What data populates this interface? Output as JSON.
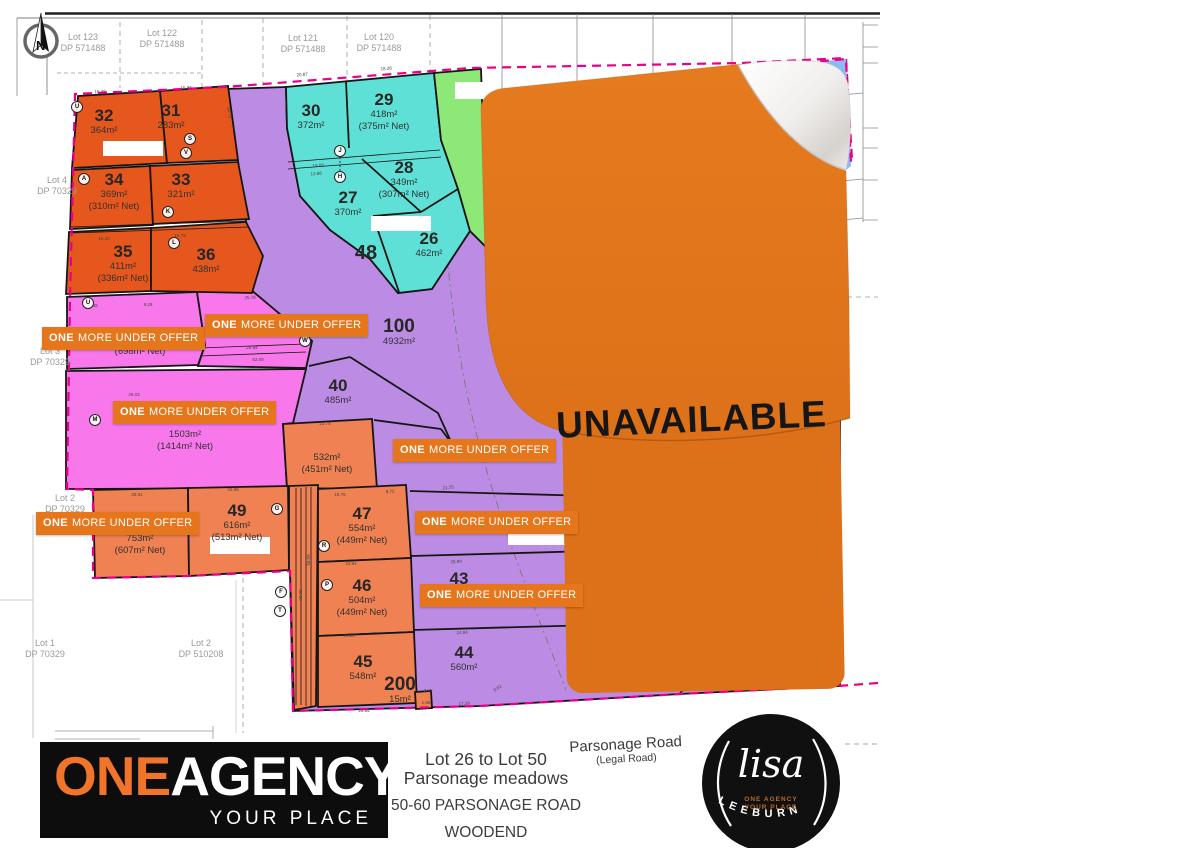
{
  "meta": {
    "unavailable": "UNAVAILABLE"
  },
  "compass": {
    "letter": "N"
  },
  "colors": {
    "lot_orange": "#E6571D",
    "lot_salmon": "#EF8152",
    "lot_teal": "#5FE0D6",
    "lot_green": "#8DE878",
    "lot_purple": "#BC8CE4",
    "lot_pink": "#F878EC",
    "banner_orange": "#E5761C",
    "sticker_orange": "#E1771E",
    "boundary_magenta": "#E8008C",
    "logo_orange": "#F0742A",
    "curl_blue": "#8ABCF2"
  },
  "neighbors": [
    {
      "l1": "Lot 123",
      "l2": "DP 571488",
      "x": 83,
      "y": 32
    },
    {
      "l1": "Lot 122",
      "l2": "DP 571488",
      "x": 162,
      "y": 28
    },
    {
      "l1": "Lot 121",
      "l2": "DP 571488",
      "x": 303,
      "y": 33
    },
    {
      "l1": "Lot 120",
      "l2": "DP 571488",
      "x": 379,
      "y": 32
    },
    {
      "l1": "Lot 4",
      "l2": "DP 70329",
      "x": 57,
      "y": 175
    },
    {
      "l1": "Lot 3",
      "l2": "DP 70329",
      "x": 50,
      "y": 346
    },
    {
      "l1": "Lot 2",
      "l2": "DP 70329",
      "x": 65,
      "y": 493
    },
    {
      "l1": "Lot 1",
      "l2": "DP 70329",
      "x": 45,
      "y": 638
    },
    {
      "l1": "Lot 2",
      "l2": "DP 510208",
      "x": 201,
      "y": 638
    }
  ],
  "lots": [
    {
      "n": "32",
      "a": "364m²",
      "x": 104,
      "y": 107
    },
    {
      "n": "31",
      "a": "283m²",
      "x": 171,
      "y": 102
    },
    {
      "n": "34",
      "a": "369m²",
      "net": "(310m² Net)",
      "x": 114,
      "y": 171
    },
    {
      "n": "33",
      "a": "321m²",
      "x": 181,
      "y": 171
    },
    {
      "n": "35",
      "a": "411m²",
      "net": "(336m² Net)",
      "x": 123,
      "y": 243
    },
    {
      "n": "36",
      "a": "438m²",
      "x": 206,
      "y": 246
    },
    {
      "n": "30",
      "a": "372m²",
      "x": 311,
      "y": 102
    },
    {
      "n": "29",
      "a": "418m²",
      "net": "(375m² Net)",
      "x": 384,
      "y": 91
    },
    {
      "n": "28",
      "a": "349m²",
      "net": "(307m² Net)",
      "x": 404,
      "y": 159
    },
    {
      "n": "27",
      "a": "370m²",
      "x": 348,
      "y": 189
    },
    {
      "n": "26",
      "a": "462m²",
      "x": 429,
      "y": 230
    },
    {
      "n": "48",
      "ns": 20,
      "x": 366,
      "y": 244
    },
    {
      "n": "100",
      "a": "4932m²",
      "ns": 19,
      "x": 399,
      "y": 318
    },
    {
      "n": "40",
      "a": "485m²",
      "x": 338,
      "y": 377
    },
    {
      "a": "532m²",
      "net": "(451m² Net)",
      "x": 327,
      "y": 452
    },
    {
      "net": "(698m² Net)",
      "x": 140,
      "y": 346
    },
    {
      "a": "1503m²",
      "net": "(1414m² Net)",
      "x": 185,
      "y": 429
    },
    {
      "a": "753m²",
      "net": "(607m² Net)",
      "x": 140,
      "y": 533
    },
    {
      "n": "49",
      "a": "616m²",
      "net": "(513m² Net)",
      "x": 237,
      "y": 502
    },
    {
      "n": "47",
      "a": "554m²",
      "net": "(449m² Net)",
      "x": 362,
      "y": 505
    },
    {
      "n": "46",
      "a": "504m²",
      "net": "(449m² Net)",
      "x": 362,
      "y": 577
    },
    {
      "n": "45",
      "a": "548m²",
      "x": 363,
      "y": 653
    },
    {
      "n": "44",
      "a": "560m²",
      "x": 464,
      "y": 644
    },
    {
      "n": "43",
      "x": 459,
      "y": 570
    },
    {
      "n": "200",
      "a": "15m²",
      "ns": 19,
      "x": 400,
      "y": 676
    }
  ],
  "banners": [
    {
      "one": "ONE",
      "rest": "MORE UNDER OFFER",
      "x": 42,
      "y": 327
    },
    {
      "one": "ONE",
      "rest": "MORE UNDER OFFER",
      "x": 205,
      "y": 314
    },
    {
      "one": "ONE",
      "rest": "MORE UNDER OFFER",
      "x": 113,
      "y": 401
    },
    {
      "one": "ONE",
      "rest": "MORE UNDER OFFER",
      "x": 36,
      "y": 512
    },
    {
      "one": "ONE",
      "rest": "MORE UNDER OFFER",
      "x": 393,
      "y": 439
    },
    {
      "one": "ONE",
      "rest": "MORE UNDER OFFER",
      "x": 415,
      "y": 511
    },
    {
      "one": "ONE",
      "rest": "MORE UNDER OFFER",
      "x": 420,
      "y": 584
    }
  ],
  "markers": [
    {
      "ltr": "U",
      "x": 77,
      "y": 107
    },
    {
      "ltr": "S",
      "x": 190,
      "y": 139
    },
    {
      "ltr": "V",
      "x": 186,
      "y": 153
    },
    {
      "ltr": "A",
      "x": 84,
      "y": 179
    },
    {
      "ltr": "K",
      "x": 168,
      "y": 212
    },
    {
      "ltr": "L",
      "x": 174,
      "y": 243
    },
    {
      "ltr": "J",
      "x": 340,
      "y": 151
    },
    {
      "ltr": "H",
      "x": 340,
      "y": 177
    },
    {
      "ltr": "W",
      "x": 305,
      "y": 341
    },
    {
      "ltr": "M",
      "x": 95,
      "y": 420
    },
    {
      "ltr": "G",
      "x": 277,
      "y": 509
    },
    {
      "ltr": "R",
      "x": 324,
      "y": 546
    },
    {
      "ltr": "P",
      "x": 327,
      "y": 585
    },
    {
      "ltr": "F",
      "x": 281,
      "y": 592
    },
    {
      "ltr": "T",
      "x": 280,
      "y": 611
    },
    {
      "ltr": "U",
      "x": 88,
      "y": 303
    }
  ],
  "dims": [
    {
      "t": "20.87",
      "x": 302,
      "y": 72,
      "r": -4
    },
    {
      "t": "18.26",
      "x": 386,
      "y": 66,
      "r": -4
    },
    {
      "t": "16.48",
      "x": 100,
      "y": 89,
      "r": -2
    },
    {
      "t": "16.94",
      "x": 186,
      "y": 85,
      "r": -2
    },
    {
      "t": "18.75",
      "x": 232,
      "y": 112,
      "r": 80
    },
    {
      "t": "19.09",
      "x": 318,
      "y": 163,
      "r": -4
    },
    {
      "t": "13.66",
      "x": 316,
      "y": 171,
      "r": -4
    },
    {
      "t": "16.40",
      "x": 104,
      "y": 236,
      "r": 0
    },
    {
      "t": "15.79",
      "x": 180,
      "y": 233,
      "r": 0
    },
    {
      "t": "25.78",
      "x": 250,
      "y": 295,
      "r": -2
    },
    {
      "t": "20.48",
      "x": 92,
      "y": 303,
      "r": 0
    },
    {
      "t": "9.29",
      "x": 148,
      "y": 302,
      "r": 0
    },
    {
      "t": "29.94",
      "x": 252,
      "y": 345,
      "r": 0
    },
    {
      "t": "62.09",
      "x": 258,
      "y": 357,
      "r": 0
    },
    {
      "t": "26.03",
      "x": 134,
      "y": 392,
      "r": 0
    },
    {
      "t": "23.74",
      "x": 325,
      "y": 421,
      "r": 0
    },
    {
      "t": "25.91",
      "x": 137,
      "y": 492,
      "r": 0
    },
    {
      "t": "25.99",
      "x": 233,
      "y": 487,
      "r": 0
    },
    {
      "t": "16.75",
      "x": 340,
      "y": 492,
      "r": 0
    },
    {
      "t": "8.75",
      "x": 390,
      "y": 489,
      "r": -3
    },
    {
      "t": "21.75",
      "x": 448,
      "y": 485,
      "r": -4
    },
    {
      "t": "24.94",
      "x": 351,
      "y": 561,
      "r": 0
    },
    {
      "t": "25.99",
      "x": 456,
      "y": 559,
      "r": -2
    },
    {
      "t": "24.94",
      "x": 349,
      "y": 633,
      "r": 0
    },
    {
      "t": "24.84",
      "x": 462,
      "y": 630,
      "r": -2
    },
    {
      "t": "24.84",
      "x": 364,
      "y": 708,
      "r": 0
    },
    {
      "t": "17.29",
      "x": 464,
      "y": 701,
      "r": -3
    },
    {
      "t": "8.62",
      "x": 496,
      "y": 686,
      "r": -35
    },
    {
      "t": "2.95",
      "x": 428,
      "y": 688,
      "r": 0
    },
    {
      "t": "1.95",
      "x": 426,
      "y": 700,
      "r": 0
    },
    {
      "t": "50.06",
      "x": 303,
      "y": 595,
      "r": 90
    },
    {
      "t": "60.85",
      "x": 311,
      "y": 560,
      "r": 90
    }
  ],
  "footer": {
    "brand_one": "ONE",
    "brand_rest": "AGENCY",
    "brand_tagline": "YOUR PLACE",
    "range_line1": "Lot 26 to Lot 50",
    "range_line2": "Parsonage meadows",
    "address_line1": "50-60 PARSONAGE ROAD",
    "address_line2": "WOODEND",
    "road_name": "Parsonage Road",
    "road_sub": "(Legal Road)",
    "agent_script": "lisa",
    "agent_name": "LEEBURN",
    "agent_small1": "ONE AGENCY",
    "agent_small2": "YOUR PLACE"
  }
}
